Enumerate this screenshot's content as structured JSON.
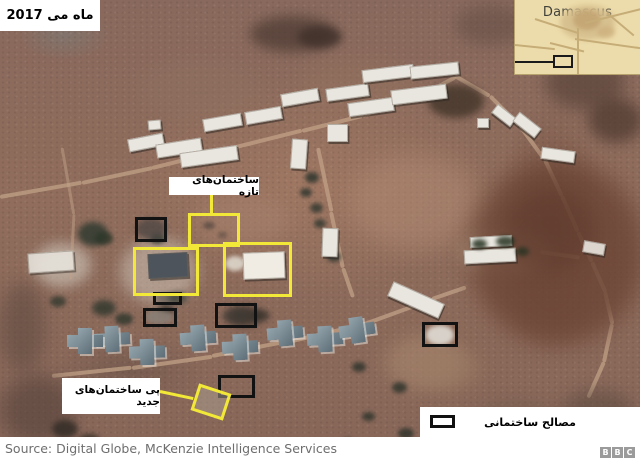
{
  "labels": {
    "date": "ماه می 2017",
    "new_buildings": "ساختمان‌های تازه",
    "foundations": "پی ساختمان‌های جدید",
    "materials": "مصالح ساختمانی"
  },
  "inset": {
    "city": "Damascus"
  },
  "source": {
    "text": "Source: Digital Globe, McKenzie Intelligence Services"
  },
  "logo": {
    "letters": [
      "B",
      "B",
      "C"
    ]
  },
  "colors": {
    "annotation_yellow": "#f2e838",
    "annotation_black": "#121212",
    "label_bg": "#ffffff",
    "map_bg": "#eddcab",
    "terrain_base": "#8d695a"
  },
  "annotations": {
    "yellow_boxes": [
      {
        "x": 188,
        "y": 213,
        "w": 52,
        "h": 34
      },
      {
        "x": 133,
        "y": 247,
        "w": 66,
        "h": 49
      },
      {
        "x": 223,
        "y": 242,
        "w": 69,
        "h": 55
      }
    ],
    "yellow_diamond": [
      {
        "x": 194,
        "y": 388,
        "w": 34,
        "h": 28,
        "r": 18
      }
    ],
    "yellow_lines": [
      {
        "x": 210,
        "y": 194,
        "w": 3,
        "h": 20,
        "r": 0
      },
      {
        "x": 160,
        "y": 390,
        "w": 34,
        "h": 3,
        "r": 12
      }
    ],
    "black_boxes": [
      {
        "x": 135,
        "y": 217,
        "w": 32,
        "h": 25
      },
      {
        "x": 153,
        "y": 292,
        "w": 29,
        "h": 13
      },
      {
        "x": 143,
        "y": 308,
        "w": 34,
        "h": 19
      },
      {
        "x": 215,
        "y": 303,
        "w": 42,
        "h": 25
      },
      {
        "x": 218,
        "y": 375,
        "w": 37,
        "h": 23
      },
      {
        "x": 422,
        "y": 322,
        "w": 36,
        "h": 25
      }
    ]
  },
  "scene": {
    "washes": [
      {
        "x": 350,
        "y": 155,
        "w": 130,
        "h": 95,
        "c": "#b28b74",
        "o": 0.5,
        "b": 12
      },
      {
        "x": 195,
        "y": 195,
        "w": 95,
        "h": 50,
        "c": "#a8836e",
        "o": 0.5,
        "b": 9
      },
      {
        "x": 385,
        "y": 335,
        "w": 80,
        "h": 55,
        "c": "#ab8a70",
        "o": 0.55,
        "b": 9
      },
      {
        "x": 120,
        "y": 238,
        "w": 78,
        "h": 66,
        "c": "#d3cabd",
        "o": 0.5,
        "b": 7
      },
      {
        "x": 33,
        "y": 243,
        "w": 58,
        "h": 44,
        "c": "#d8d2c6",
        "o": 0.55,
        "b": 6
      },
      {
        "x": 418,
        "y": 348,
        "w": 64,
        "h": 42,
        "c": "#9c7c64",
        "o": 0.5,
        "b": 8
      },
      {
        "x": 300,
        "y": 60,
        "w": 120,
        "h": 50,
        "c": "#97745f",
        "o": 0.4,
        "b": 10
      },
      {
        "x": 458,
        "y": 228,
        "w": 95,
        "h": 48,
        "c": "#b49a82",
        "o": 0.5,
        "b": 6
      },
      {
        "x": 140,
        "y": 60,
        "w": 120,
        "h": 60,
        "c": "#8f7362",
        "o": 0.4,
        "b": 10
      }
    ],
    "roads": [
      {
        "x": 0,
        "y": 195,
        "w": 83,
        "h": 4,
        "r": -10
      },
      {
        "x": 82,
        "y": 181,
        "w": 72,
        "h": 4,
        "r": -12
      },
      {
        "x": 152,
        "y": 166,
        "w": 82,
        "h": 4,
        "r": -14
      },
      {
        "x": 232,
        "y": 146,
        "w": 72,
        "h": 4,
        "r": -14
      },
      {
        "x": 302,
        "y": 129,
        "w": 62,
        "h": 4,
        "r": -14
      },
      {
        "x": 362,
        "y": 114,
        "w": 64,
        "h": 4,
        "r": -19
      },
      {
        "x": 422,
        "y": 93,
        "w": 38,
        "h": 4,
        "r": -28
      },
      {
        "x": 455,
        "y": 74,
        "w": 40,
        "h": 4,
        "r": 30
      },
      {
        "x": 490,
        "y": 94,
        "w": 42,
        "h": 4,
        "r": 45
      },
      {
        "x": 520,
        "y": 124,
        "w": 42,
        "h": 4,
        "r": 54
      },
      {
        "x": 545,
        "y": 158,
        "w": 40,
        "h": 4,
        "r": 65
      },
      {
        "x": 562,
        "y": 194,
        "w": 39,
        "h": 4,
        "r": 66
      },
      {
        "x": 578,
        "y": 230,
        "w": 33,
        "h": 4,
        "r": 65
      },
      {
        "x": 592,
        "y": 260,
        "w": 33,
        "h": 4,
        "r": 66
      },
      {
        "x": 605,
        "y": 290,
        "w": 33,
        "h": 4,
        "r": 77
      },
      {
        "x": 612,
        "y": 322,
        "w": 39,
        "h": 4,
        "r": 102
      },
      {
        "x": 604,
        "y": 360,
        "w": 39,
        "h": 4,
        "r": 114
      },
      {
        "x": 318,
        "y": 146,
        "w": 65,
        "h": 4,
        "r": 78
      },
      {
        "x": 331,
        "y": 210,
        "w": 57,
        "h": 4,
        "r": 78
      },
      {
        "x": 343,
        "y": 266,
        "w": 31,
        "h": 4,
        "r": 71
      },
      {
        "x": 52,
        "y": 374,
        "w": 80,
        "h": 4,
        "r": -6
      },
      {
        "x": 132,
        "y": 366,
        "w": 81,
        "h": 4,
        "r": -8
      },
      {
        "x": 212,
        "y": 354,
        "w": 81,
        "h": 4,
        "r": -11
      },
      {
        "x": 292,
        "y": 339,
        "w": 72,
        "h": 4,
        "r": -13
      },
      {
        "x": 362,
        "y": 323,
        "w": 75,
        "h": 4,
        "r": -20
      },
      {
        "x": 432,
        "y": 297,
        "w": 36,
        "h": 4,
        "r": -19
      },
      {
        "x": 540,
        "y": 250,
        "w": 40,
        "h": 4,
        "r": 8
      },
      {
        "x": 62,
        "y": 146,
        "w": 68,
        "h": 3,
        "r": 80,
        "o": 0.5
      },
      {
        "x": 74,
        "y": 213,
        "w": 65,
        "h": 3,
        "r": 93,
        "o": 0.5
      }
    ],
    "blobs": [
      {
        "x": 250,
        "y": 16,
        "w": 85,
        "h": 36,
        "c": "#4e3c34",
        "o": 0.75,
        "b": 6
      },
      {
        "x": 298,
        "y": 26,
        "w": 44,
        "h": 22,
        "c": "#3f302a",
        "o": 0.8,
        "b": 4
      },
      {
        "x": 455,
        "y": 5,
        "w": 70,
        "h": 40,
        "c": "#5e4a42",
        "o": 0.5,
        "b": 8
      },
      {
        "x": 428,
        "y": 84,
        "w": 56,
        "h": 34,
        "c": "#413428",
        "o": 0.8,
        "b": 4
      },
      {
        "x": 545,
        "y": 55,
        "w": 80,
        "h": 55,
        "c": "#5a443a",
        "o": 0.7,
        "b": 8
      },
      {
        "x": 588,
        "y": 98,
        "w": 55,
        "h": 45,
        "c": "#4c382e",
        "o": 0.7,
        "b": 7
      },
      {
        "x": 470,
        "y": 160,
        "w": 175,
        "h": 185,
        "c": "#6a4334",
        "o": 0.8,
        "b": 12
      },
      {
        "x": 505,
        "y": 190,
        "w": 90,
        "h": 80,
        "c": "#5d3a2d",
        "o": 0.5,
        "b": 10
      },
      {
        "x": 560,
        "y": 390,
        "w": 75,
        "h": 48,
        "c": "#55463c",
        "o": 0.5,
        "b": 8
      },
      {
        "x": 470,
        "y": 400,
        "w": 90,
        "h": 35,
        "c": "#6d584a",
        "o": 0.45,
        "b": 7
      },
      {
        "x": 0,
        "y": 282,
        "w": 45,
        "h": 90,
        "c": "#5f4a40",
        "o": 0.6,
        "b": 9
      },
      {
        "x": 0,
        "y": 375,
        "w": 75,
        "h": 70,
        "c": "#54413a",
        "o": 0.6,
        "b": 9
      },
      {
        "x": 52,
        "y": 420,
        "w": 26,
        "h": 18,
        "c": "#2f2a24",
        "o": 0.8,
        "b": 3
      },
      {
        "x": 78,
        "y": 434,
        "w": 22,
        "h": 14,
        "c": "#2f2a24",
        "o": 0.8,
        "b": 3
      },
      {
        "x": 78,
        "y": 222,
        "w": 30,
        "h": 24,
        "c": "#313b31",
        "o": 0.85,
        "b": 3
      },
      {
        "x": 92,
        "y": 300,
        "w": 24,
        "h": 16,
        "c": "#2e362c",
        "o": 0.8,
        "b": 3
      },
      {
        "x": 50,
        "y": 296,
        "w": 16,
        "h": 11,
        "c": "#2e362c",
        "o": 0.75,
        "b": 2
      },
      {
        "x": 115,
        "y": 313,
        "w": 18,
        "h": 12,
        "c": "#2e362c",
        "o": 0.8,
        "b": 2
      },
      {
        "x": 150,
        "y": 233,
        "w": 15,
        "h": 11,
        "c": "#333d33",
        "o": 0.8,
        "b": 2
      },
      {
        "x": 228,
        "y": 306,
        "w": 34,
        "h": 20,
        "c": "#35302a",
        "o": 0.8,
        "b": 4
      },
      {
        "x": 158,
        "y": 304,
        "w": 16,
        "h": 11,
        "c": "#35302a",
        "o": 0.8,
        "b": 3
      },
      {
        "x": 305,
        "y": 172,
        "w": 14,
        "h": 11,
        "c": "#2f362e",
        "o": 0.85,
        "b": 2
      },
      {
        "x": 300,
        "y": 188,
        "w": 12,
        "h": 9,
        "c": "#2f362e",
        "o": 0.85,
        "b": 2
      },
      {
        "x": 310,
        "y": 203,
        "w": 13,
        "h": 10,
        "c": "#2f362e",
        "o": 0.8,
        "b": 2
      },
      {
        "x": 314,
        "y": 219,
        "w": 12,
        "h": 9,
        "c": "#2f362e",
        "o": 0.8,
        "b": 2
      },
      {
        "x": 327,
        "y": 252,
        "w": 14,
        "h": 10,
        "c": "#2f362e",
        "o": 0.8,
        "b": 2
      },
      {
        "x": 352,
        "y": 362,
        "w": 14,
        "h": 10,
        "c": "#2c322a",
        "o": 0.8,
        "b": 2
      },
      {
        "x": 392,
        "y": 382,
        "w": 15,
        "h": 11,
        "c": "#2c322a",
        "o": 0.8,
        "b": 2
      },
      {
        "x": 362,
        "y": 412,
        "w": 13,
        "h": 9,
        "c": "#2c322a",
        "o": 0.8,
        "b": 2
      },
      {
        "x": 398,
        "y": 428,
        "w": 16,
        "h": 11,
        "c": "#2c322a",
        "o": 0.8,
        "b": 2
      },
      {
        "x": 342,
        "y": 438,
        "w": 12,
        "h": 9,
        "c": "#2c322a",
        "o": 0.8,
        "b": 2
      },
      {
        "x": 136,
        "y": 218,
        "w": 30,
        "h": 22,
        "c": "#4a4442",
        "o": 0.75,
        "b": 3
      },
      {
        "x": 222,
        "y": 308,
        "w": 30,
        "h": 16,
        "c": "#3f3a34",
        "o": 0.7,
        "b": 3
      },
      {
        "x": 203,
        "y": 222,
        "w": 12,
        "h": 7,
        "c": "#4a403a",
        "o": 0.7,
        "b": 2
      },
      {
        "x": 218,
        "y": 232,
        "w": 9,
        "h": 6,
        "c": "#4a403a",
        "o": 0.6,
        "b": 2
      },
      {
        "x": 225,
        "y": 256,
        "w": 20,
        "h": 15,
        "c": "#ded8cc",
        "o": 0.9,
        "b": 2
      },
      {
        "x": 426,
        "y": 325,
        "w": 28,
        "h": 20,
        "c": "#dcd7cf",
        "o": 0.95,
        "b": 2
      },
      {
        "x": 145,
        "y": 310,
        "w": 28,
        "h": 14,
        "c": "#8a8178",
        "o": 0.85,
        "b": 2
      },
      {
        "x": 155,
        "y": 293,
        "w": 24,
        "h": 10,
        "c": "#6f675f",
        "o": 0.85,
        "b": 2
      }
    ],
    "buildings": [
      {
        "x": 128,
        "y": 136,
        "w": 36,
        "h": 13,
        "r": -11
      },
      {
        "x": 156,
        "y": 141,
        "w": 46,
        "h": 14,
        "r": -9
      },
      {
        "x": 180,
        "y": 149,
        "w": 58,
        "h": 15,
        "r": -8
      },
      {
        "x": 203,
        "y": 116,
        "w": 39,
        "h": 13,
        "r": -10
      },
      {
        "x": 245,
        "y": 109,
        "w": 37,
        "h": 13,
        "r": -10
      },
      {
        "x": 281,
        "y": 91,
        "w": 38,
        "h": 13,
        "r": -10
      },
      {
        "x": 326,
        "y": 86,
        "w": 43,
        "h": 13,
        "r": -8
      },
      {
        "x": 348,
        "y": 100,
        "w": 46,
        "h": 14,
        "r": -8
      },
      {
        "x": 362,
        "y": 67,
        "w": 52,
        "h": 13,
        "r": -7
      },
      {
        "x": 410,
        "y": 64,
        "w": 49,
        "h": 13,
        "r": -6
      },
      {
        "x": 391,
        "y": 87,
        "w": 56,
        "h": 15,
        "r": -7
      },
      {
        "x": 388,
        "y": 292,
        "w": 56,
        "h": 16,
        "r": 24
      },
      {
        "x": 541,
        "y": 149,
        "w": 34,
        "h": 12,
        "r": 8
      },
      {
        "x": 492,
        "y": 110,
        "w": 24,
        "h": 11,
        "r": 38
      },
      {
        "x": 513,
        "y": 119,
        "w": 28,
        "h": 12,
        "r": 38
      },
      {
        "x": 327,
        "y": 124,
        "w": 21,
        "h": 18,
        "r": 0
      },
      {
        "x": 291,
        "y": 139,
        "w": 16,
        "h": 30,
        "r": 4
      },
      {
        "x": 322,
        "y": 228,
        "w": 16,
        "h": 29,
        "r": 2
      },
      {
        "x": 477,
        "y": 118,
        "w": 12,
        "h": 10,
        "r": 0
      },
      {
        "x": 148,
        "y": 120,
        "w": 13,
        "h": 10,
        "r": -5
      },
      {
        "x": 470,
        "y": 236,
        "w": 42,
        "h": 11,
        "r": -3
      },
      {
        "x": 464,
        "y": 249,
        "w": 52,
        "h": 14,
        "r": -3
      },
      {
        "x": 243,
        "y": 252,
        "w": 42,
        "h": 27,
        "r": -2,
        "c": "#f0ece4"
      },
      {
        "x": 148,
        "y": 253,
        "w": 40,
        "h": 25,
        "r": -3,
        "c": "#4d545b"
      },
      {
        "x": 28,
        "y": 252,
        "w": 46,
        "h": 20,
        "r": -4,
        "o": 0.85
      },
      {
        "x": 583,
        "y": 242,
        "w": 22,
        "h": 12,
        "r": 10,
        "o": 0.9
      }
    ],
    "crosses": [
      {
        "x": 112,
        "y": 339,
        "r": -3
      },
      {
        "x": 147,
        "y": 352,
        "r": -2
      },
      {
        "x": 198,
        "y": 338,
        "r": -4
      },
      {
        "x": 240,
        "y": 347,
        "r": -3
      },
      {
        "x": 285,
        "y": 333,
        "r": -5
      },
      {
        "x": 325,
        "y": 339,
        "r": -3
      },
      {
        "x": 85,
        "y": 341,
        "r": 0
      },
      {
        "x": 357,
        "y": 330,
        "r": -8
      }
    ],
    "overblobs": [
      {
        "x": 472,
        "y": 239,
        "w": 15,
        "h": 10,
        "c": "#273322",
        "o": 0.85,
        "b": 2
      },
      {
        "x": 496,
        "y": 236,
        "w": 19,
        "h": 11,
        "c": "#273322",
        "o": 0.85,
        "b": 2
      },
      {
        "x": 516,
        "y": 247,
        "w": 13,
        "h": 9,
        "c": "#273322",
        "o": 0.8,
        "b": 2
      },
      {
        "x": 95,
        "y": 232,
        "w": 18,
        "h": 13,
        "c": "#2c3629",
        "o": 0.8,
        "b": 2
      },
      {
        "x": 168,
        "y": 292,
        "w": 20,
        "h": 12,
        "c": "#333d33",
        "o": 0.7,
        "b": 3
      },
      {
        "x": 252,
        "y": 310,
        "w": 18,
        "h": 11,
        "c": "#35302a",
        "o": 0.75,
        "b": 3
      }
    ],
    "inset_blobs": [
      {
        "x": 45,
        "y": 5,
        "w": 55,
        "h": 35,
        "c": "#d5bd8c",
        "o": 0.9,
        "b": 3
      },
      {
        "x": 58,
        "y": 10,
        "w": 28,
        "h": 20,
        "c": "#c3a573",
        "o": 0.9,
        "b": 2
      },
      {
        "x": 82,
        "y": 26,
        "w": 18,
        "h": 12,
        "c": "#cdb17e",
        "o": 0.8,
        "b": 2
      }
    ],
    "inset_roads": [
      {
        "x": 0,
        "y": 44,
        "w": 40,
        "h": 2,
        "r": 6
      },
      {
        "x": 35,
        "y": 42,
        "w": 35,
        "h": 2,
        "r": 14
      },
      {
        "x": 60,
        "y": 38,
        "w": 66,
        "h": 2,
        "r": 8
      },
      {
        "x": 62,
        "y": 28,
        "w": 2,
        "h": 47,
        "r": 0
      },
      {
        "x": 70,
        "y": 22,
        "w": 60,
        "h": 2,
        "r": -14
      },
      {
        "x": 20,
        "y": 18,
        "w": 45,
        "h": 2,
        "r": 18
      },
      {
        "x": 92,
        "y": 12,
        "w": 35,
        "h": 2,
        "r": 40
      }
    ]
  }
}
